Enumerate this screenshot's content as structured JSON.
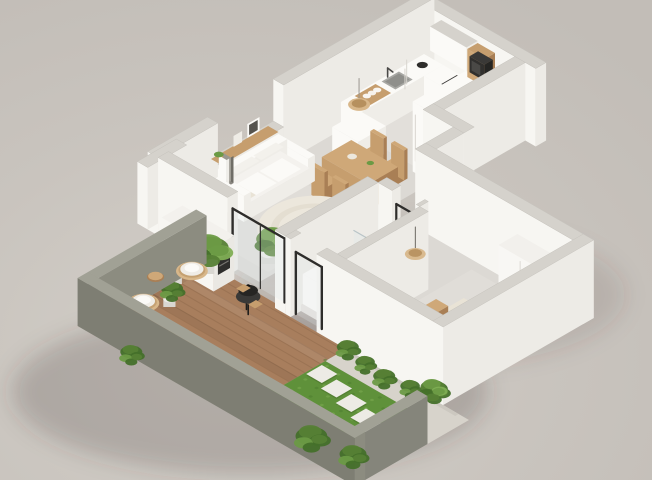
{
  "scene": {
    "type": "isometric-3d-floorplan-render",
    "backdrop": "warm gray studio background",
    "view": "bird's-eye isometric, roofless apartment model"
  },
  "background": {
    "top": "#c2bdb7",
    "mid": "#c9c4be",
    "center": "#d3cfc8"
  },
  "palette": {
    "wallTop": "#d5d2cc",
    "wallFaceLight": "#f7f6f2",
    "wallFaceShade": "#edebe6",
    "wallEdge": "#c6c3bd",
    "oliveTop": "#a1a195",
    "oliveInner": "#8c8c80",
    "oliveFront": "#7e7e73",
    "oliveDark": "#73736a",
    "floorInterior": "#dcd9d4",
    "floorBath": "#e4e1dc",
    "floorPatch": "#e7e4df",
    "deckWood": "#a87e5d",
    "deckSeam": "#7e5c41",
    "gravel": "#d7d3cb",
    "grass": "#5f913a",
    "grassDark": "#4c7b2d",
    "grassLight": "#7fae54",
    "paver": "#edebe5",
    "rug": "#ece7dc",
    "rugRing": "#ded7c8",
    "woodLight": "#cfa878",
    "wood": "#c69e6e",
    "woodDark": "#a97f55",
    "rattan": "#d8b78a",
    "rattanDark": "#b6905e",
    "white": "#fbfaf7",
    "whiteShade": "#efede8",
    "cream": "#e9e3d6",
    "black": "#2e2d2b",
    "charcoal": "#3a3937",
    "steel": "#b0b0ad",
    "glass": "#dfe9ec",
    "plantDark": "#44702a",
    "plant": "#567f35",
    "plantMid": "#6b9a44",
    "plantLight": "#7fae54",
    "potWhite": "#eceae6",
    "potShade": "#d9d7d1",
    "shadow": "rgba(62,60,53,0.22)",
    "shadowSoft": "rgba(62,60,53,0.12)"
  },
  "rooms": [
    {
      "name": "kitchen",
      "furniture": [
        "l-shaped-counter",
        "sink",
        "faucet",
        "dish-rack",
        "kettle",
        "cooktop",
        "oven",
        "upper-cabinets",
        "wood-wall-panel",
        "microwave",
        "tall-cabinet",
        "breakfast-bar",
        "rattan-pendant-lamp"
      ]
    },
    {
      "name": "dining-area",
      "furniture": [
        "wood-dining-table",
        "dining-chairs-x4",
        "bowl",
        "small-plant"
      ]
    },
    {
      "name": "living-room",
      "furniture": [
        "white-sofa",
        "seat-cushions",
        "throw-blanket",
        "half-wall-shelf",
        "picture-frames",
        "books",
        "round-rug",
        "wood-coffee-table",
        "stools-x3",
        "fiddle-leaf-plant"
      ]
    },
    {
      "name": "bathroom",
      "furniture": [
        "vanity-cabinet",
        "basin",
        "towel",
        "toilet",
        "walk-in-shower",
        "glass-screen",
        "small-plant",
        "black-door-frame"
      ]
    },
    {
      "name": "bedroom",
      "furniture": [
        "double-bed",
        "pillows-x2",
        "beige-throw",
        "foot-bench",
        "wardrobe",
        "rattan-pendant-lamp",
        "glass-globe-floor-lamp"
      ]
    },
    {
      "name": "terrace-deck",
      "furniture": [
        "wood-plank-deck",
        "rattan-lounge-chairs-x2",
        "side-table",
        "kamado-grill",
        "outdoor-media-cabinet",
        "potted-palms-x3",
        "sliding-glass-door",
        "black-door-frame"
      ]
    },
    {
      "name": "garden",
      "furniture": [
        "grass-strip",
        "stepping-stones-x6",
        "gravel-border",
        "ferns",
        "overhanging-plants",
        "olive-planter-walls"
      ]
    }
  ],
  "structure": {
    "interior_walls": "white, tall, gray-capped",
    "terrace_walls": "olive-green parapet, lower height",
    "openings": [
      "sliding-glass-door-living-to-deck",
      "deck-door-to-bathroom-hall",
      "bathroom-door",
      "corridor-opening"
    ]
  }
}
